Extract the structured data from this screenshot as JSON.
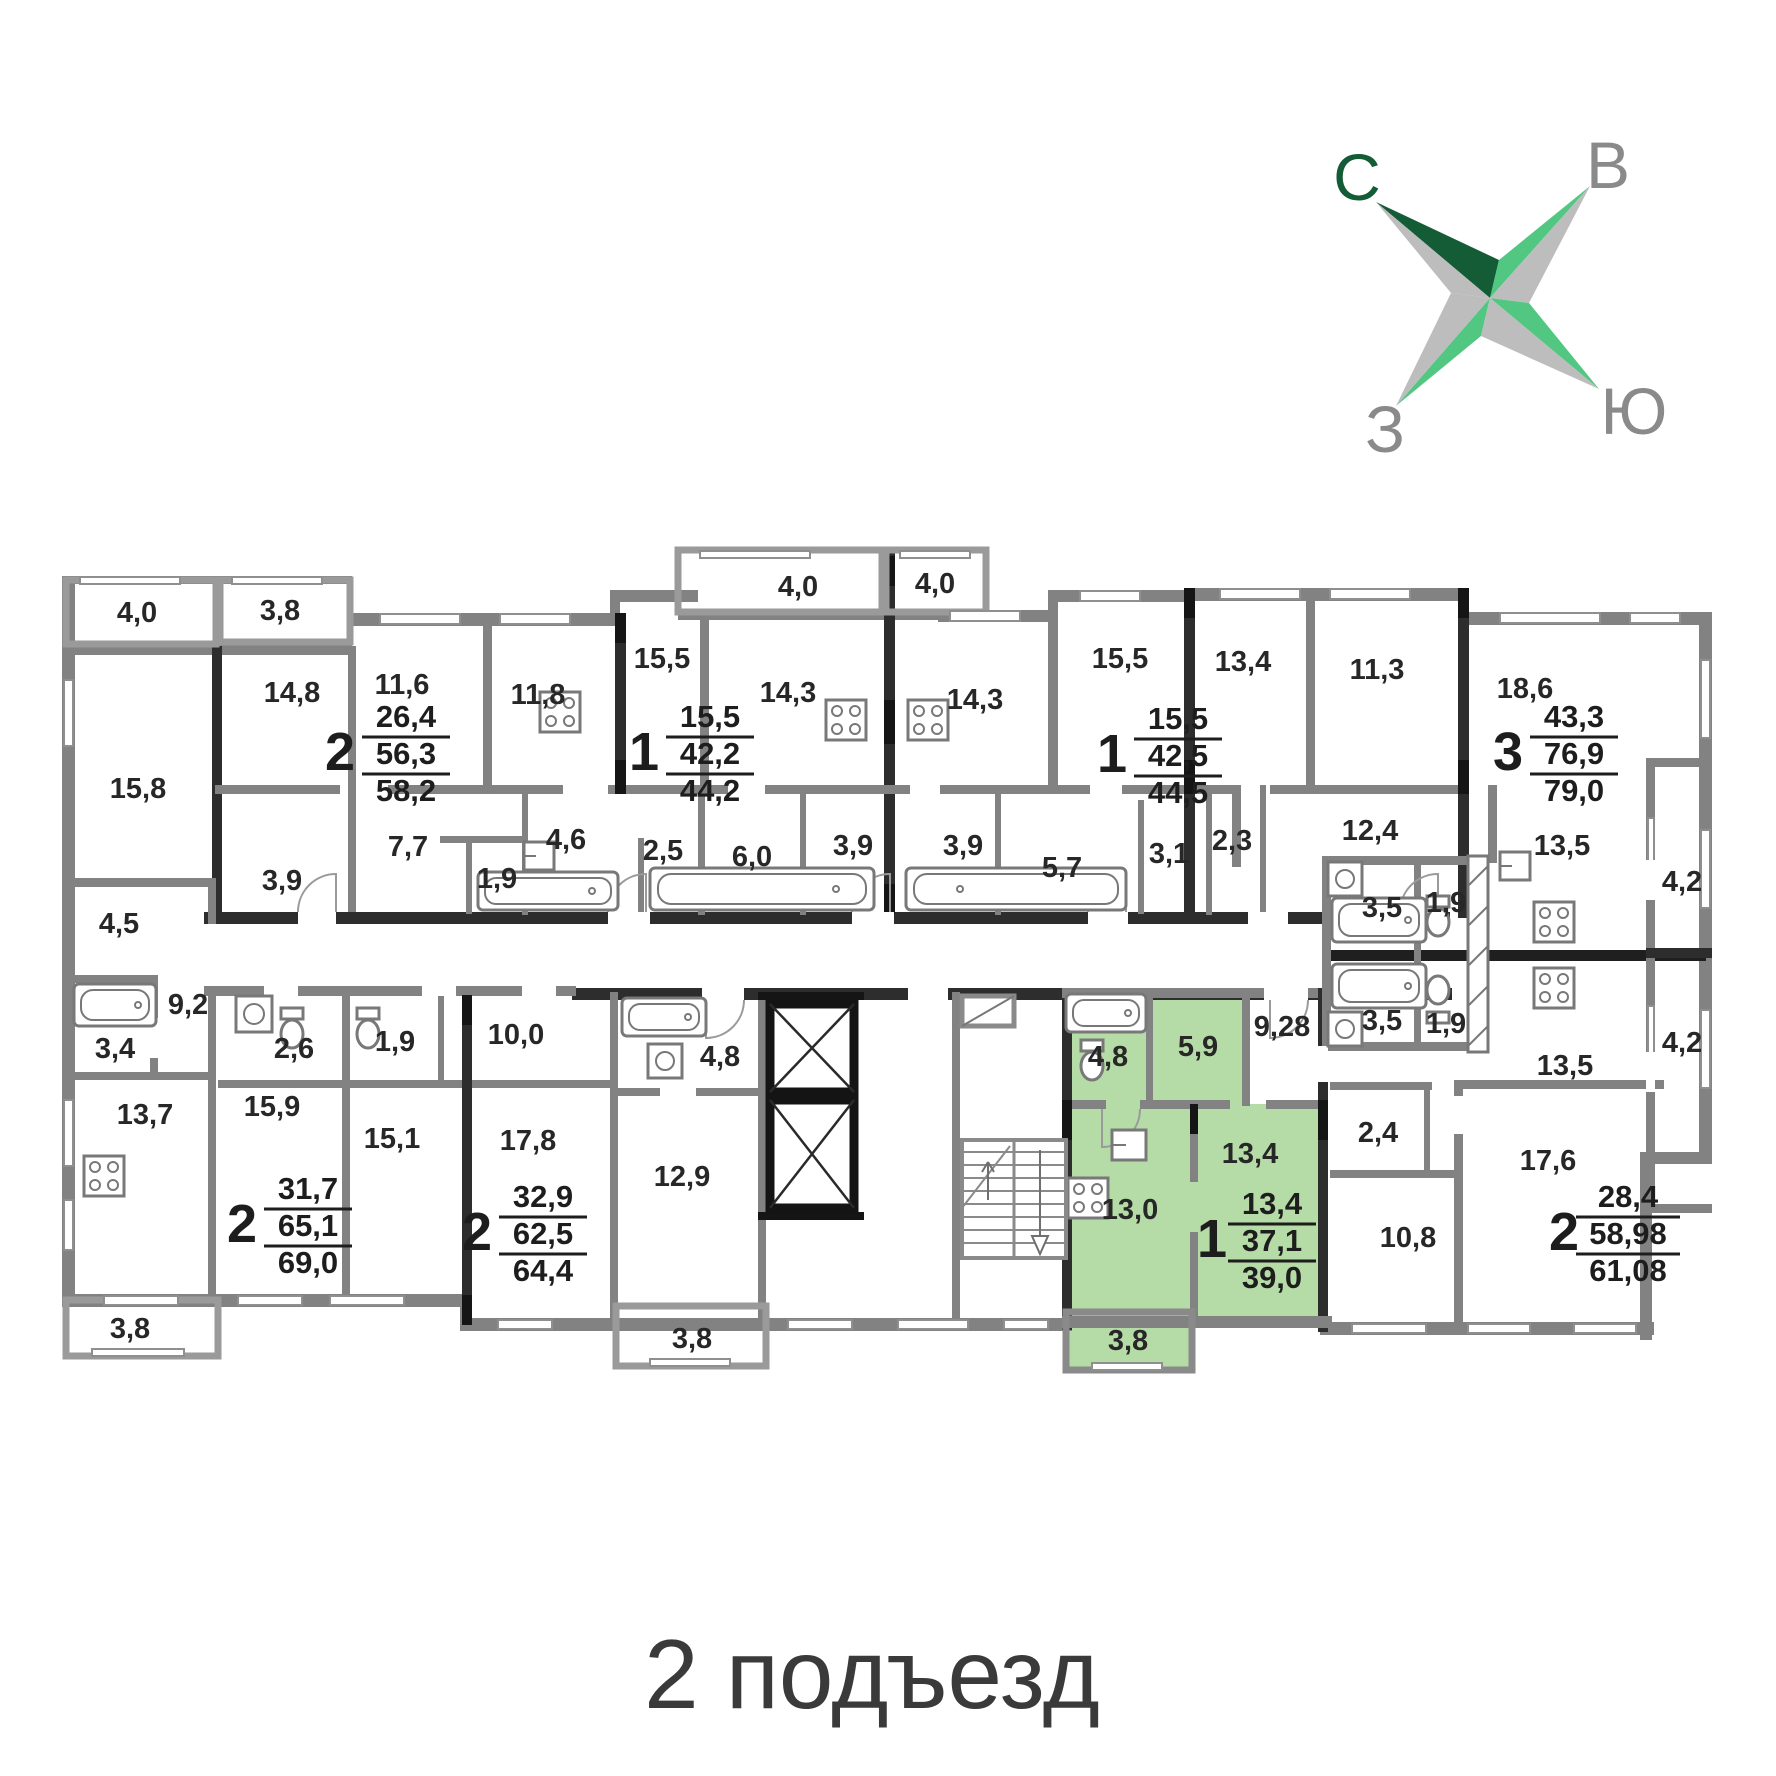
{
  "caption": "2 подъезд",
  "compass": {
    "north": "С",
    "east": "В",
    "west": "З",
    "south": "Ю"
  },
  "colors": {
    "highlight_green": "#b5dba6",
    "compass_dark_green": "#135c36",
    "compass_green": "#52c782",
    "compass_gray": "#bdbdbd",
    "wall_gray": "#828282",
    "wall_dark": "#2d2d2d"
  },
  "room_areas": [
    "4,0",
    "3,8",
    "14,8",
    "11,6",
    "11,8",
    "15,5",
    "4,0",
    "4,0",
    "14,3",
    "14,3",
    "15,5",
    "13,4",
    "11,3",
    "18,6",
    "7,7",
    "1,9",
    "4,6",
    "2,5",
    "6,0",
    "3,9",
    "3,9",
    "5,7",
    "3,1",
    "2,3",
    "12,4",
    "13,5",
    "4,2",
    "15,8",
    "4,5",
    "9,2",
    "3,4",
    "13,7",
    "2,6",
    "1,9",
    "10,0",
    "15,9",
    "15,1",
    "17,8",
    "4,8",
    "12,9",
    "3,8",
    "3,8",
    "9,28",
    "3,5",
    "1,9",
    "3,5",
    "1,9",
    "13,5",
    "4,2",
    "4,8",
    "5,9",
    "13,0",
    "13,4",
    "3,8",
    "2,4",
    "10,8",
    "17,6",
    "3,9"
  ],
  "apartments": [
    {
      "rooms": "2",
      "living_area": "26,4",
      "apartment_area": "56,3",
      "total_area": "58,2"
    },
    {
      "rooms": "1",
      "living_area": "15,5",
      "apartment_area": "42,2",
      "total_area": "44,2"
    },
    {
      "rooms": "1",
      "living_area": "15,5",
      "apartment_area": "42,5",
      "total_area": "44,5"
    },
    {
      "rooms": "3",
      "living_area": "43,3",
      "apartment_area": "76,9",
      "total_area": "79,0"
    },
    {
      "rooms": "2",
      "living_area": "31,7",
      "apartment_area": "65,1",
      "total_area": "69,0"
    },
    {
      "rooms": "2",
      "living_area": "32,9",
      "apartment_area": "62,5",
      "total_area": "64,4"
    },
    {
      "rooms": "1",
      "living_area": "13,4",
      "apartment_area": "37,1",
      "total_area": "39,0"
    },
    {
      "rooms": "2",
      "living_area": "28,4",
      "apartment_area": "58,98",
      "total_area": "61,08"
    }
  ]
}
